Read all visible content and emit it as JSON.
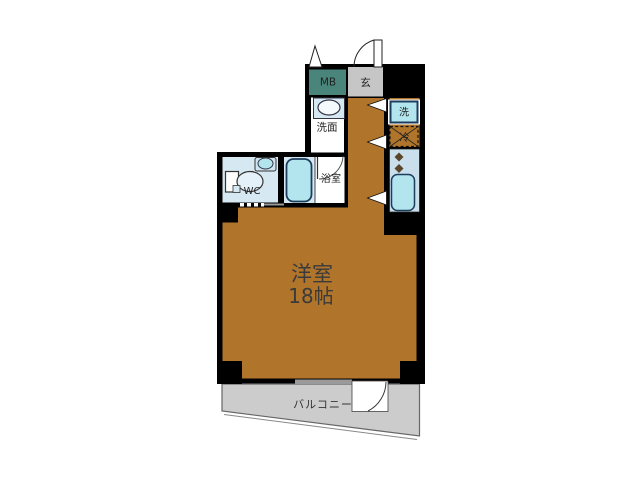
{
  "floorplan": {
    "labels": {
      "mb": "MB",
      "genkan": "玄",
      "senmen": "洗面",
      "washer": "洗",
      "fridge": "冷",
      "wc": "WC",
      "bathroom": "浴室",
      "room_name": "洋室",
      "room_size": "18帖",
      "balcony": "バルコニー"
    },
    "colors": {
      "wall": "#000000",
      "room": "#b0752b",
      "balcony": "#cccccc",
      "genkan": "#c6c6c6",
      "mb": "#4a857c",
      "wet_floor": "#d6e9f3",
      "fixture": "#b3e5ee",
      "counter": "#c9dfeb",
      "fixture_border": "#1d3d5c"
    }
  }
}
